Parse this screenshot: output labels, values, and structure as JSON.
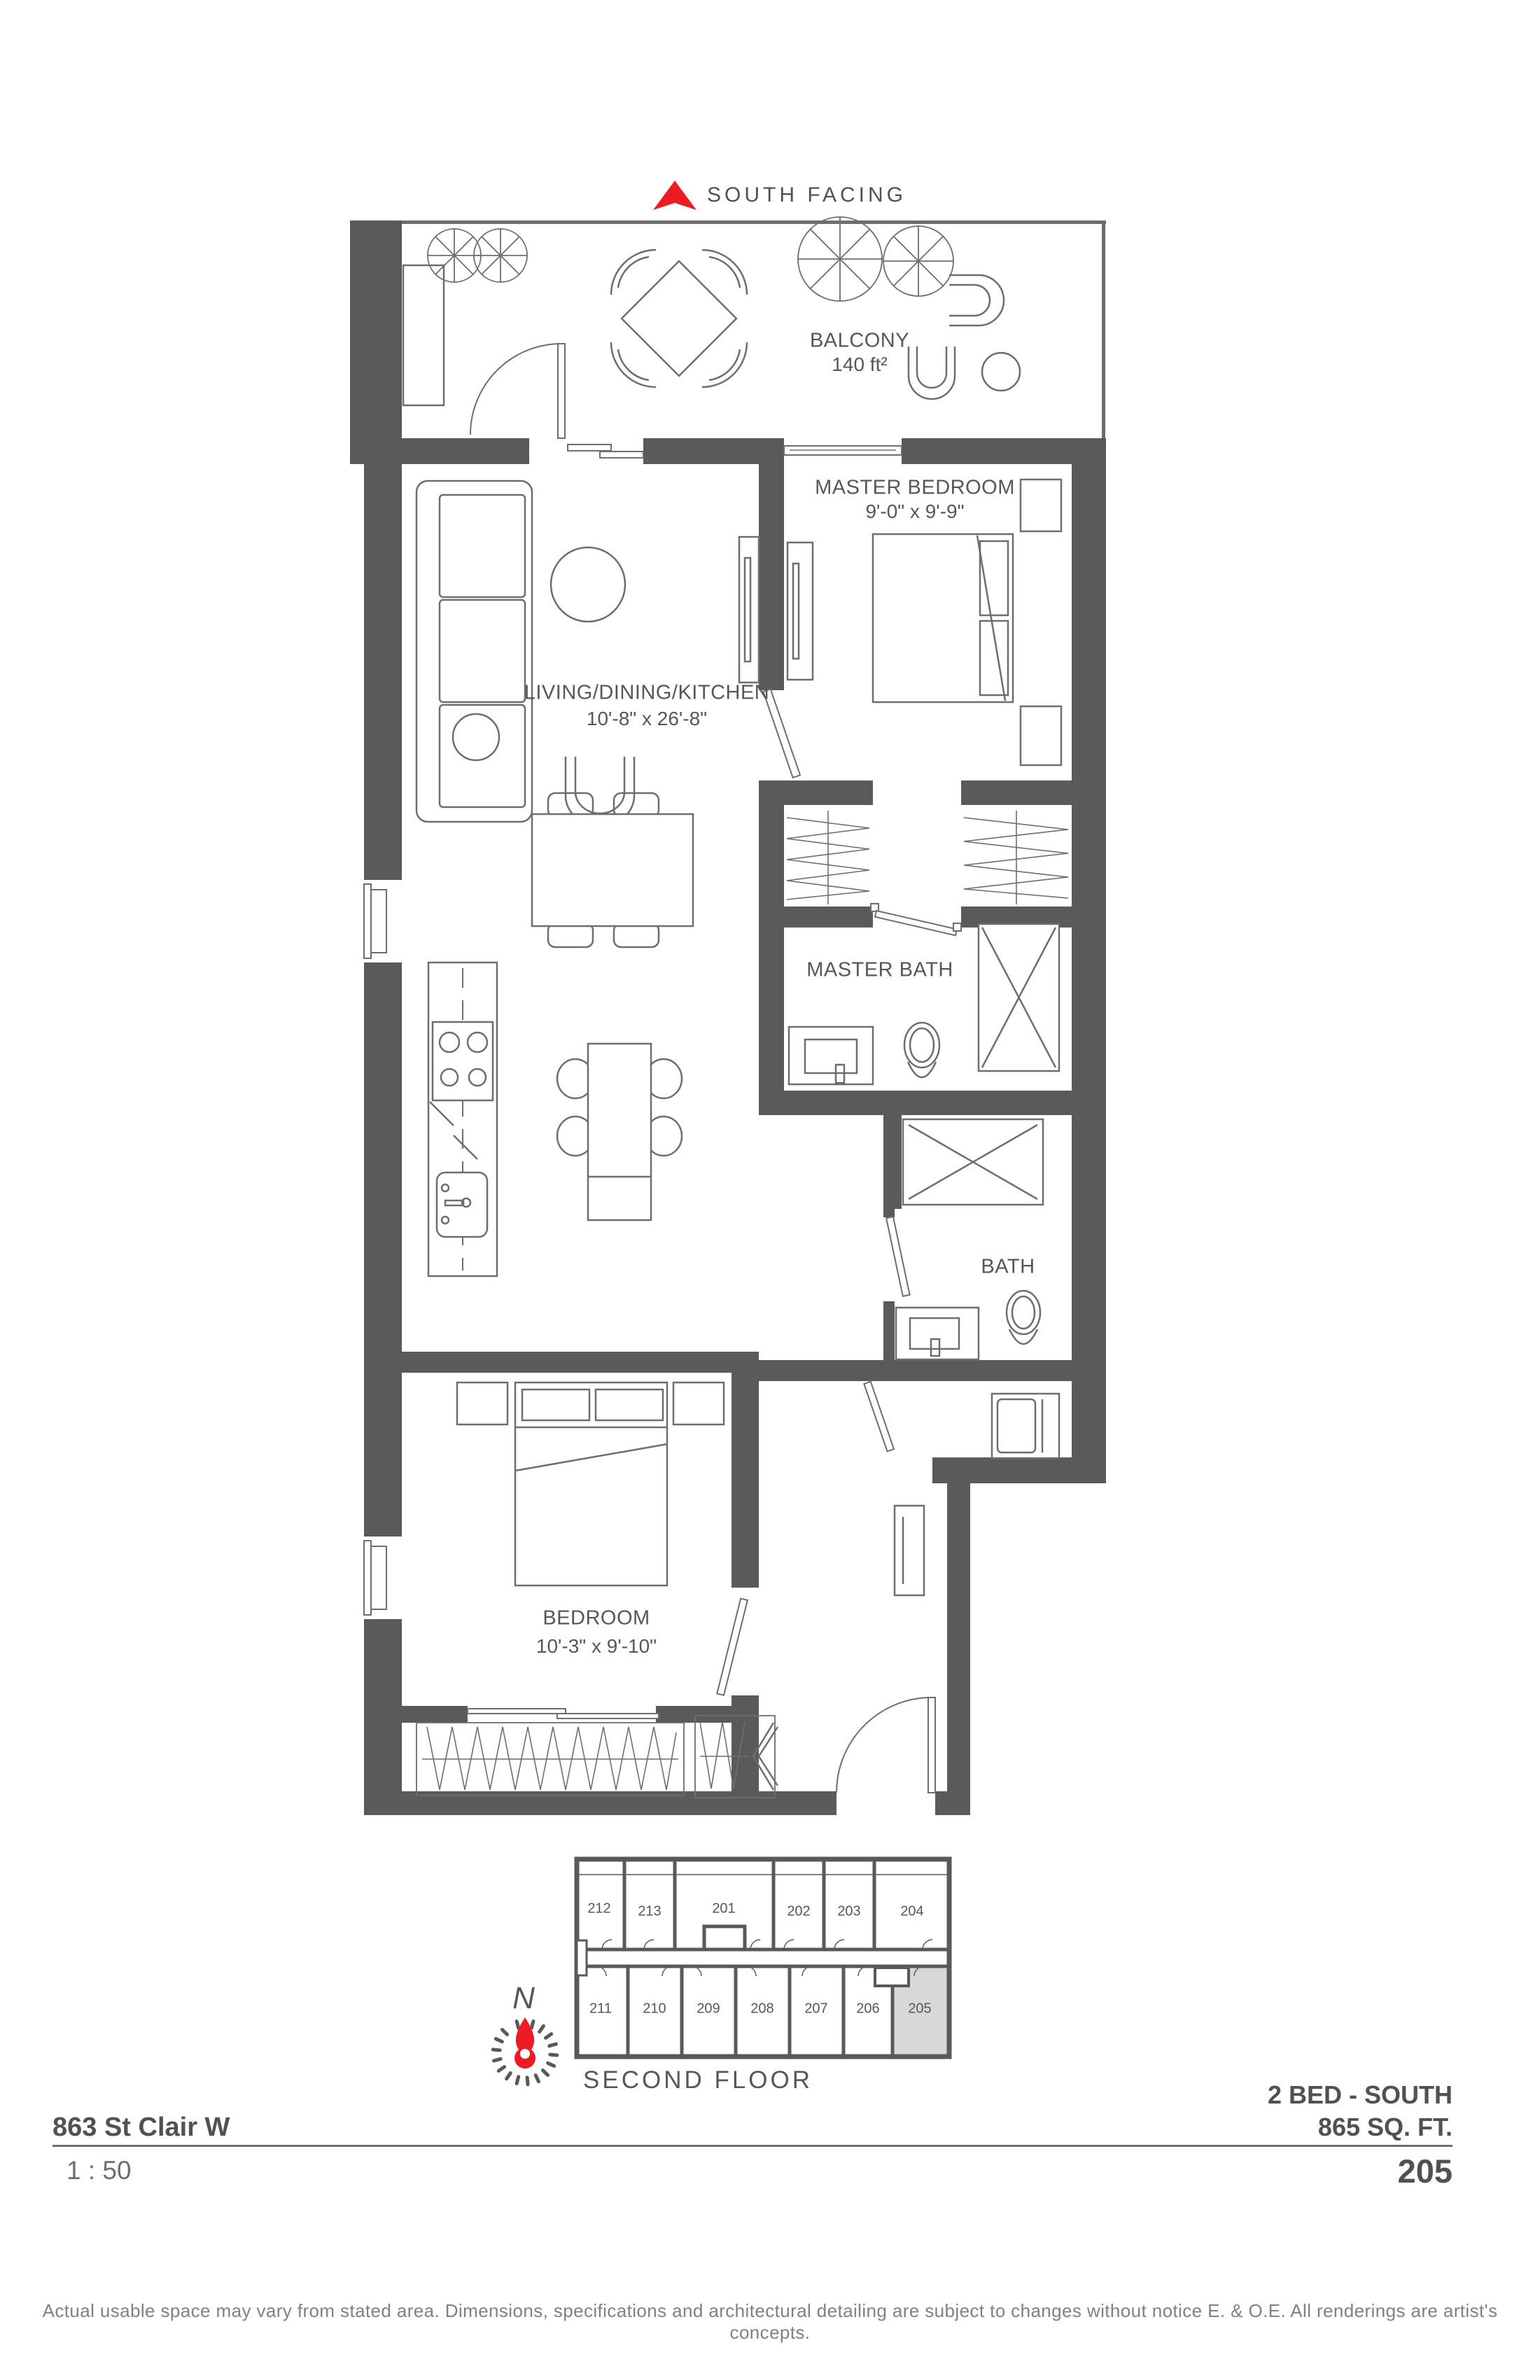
{
  "header": {
    "south_facing": "SOUTH FACING"
  },
  "plan": {
    "balcony": {
      "name": "BALCONY",
      "area": "140 ft²"
    },
    "master_bedroom": {
      "name": "MASTER BEDROOM",
      "dims": "9'-0\" x 9'-9\""
    },
    "living": {
      "name": "LIVING/DINING/KITCHEN",
      "dims": "10'-8\" x 26'-8\""
    },
    "master_bath": {
      "name": "MASTER BATH"
    },
    "bath": {
      "name": "BATH"
    },
    "bedroom": {
      "name": "BEDROOM",
      "dims": "10'-3\" x 9'-10\""
    }
  },
  "keyplan": {
    "compass_label": "N",
    "floor_label": "SECOND FLOOR",
    "highlighted_unit": "205",
    "top_row": [
      "212",
      "213",
      "201",
      "202",
      "203",
      "204"
    ],
    "bottom_row": [
      "211",
      "210",
      "209",
      "208",
      "207",
      "206",
      "205"
    ]
  },
  "titleblock": {
    "address": "863 St Clair W",
    "scale": "1 : 50",
    "unit_type": "2 BED  - SOUTH",
    "area": "865 SQ. FT.",
    "unit_number": "205"
  },
  "footer": {
    "disclaimer": "Actual usable space may vary from stated area. Dimensions, specifications and architectural detailing are subject to changes without notice E. & O.E. All renderings are artist's concepts."
  },
  "colors": {
    "wall": "#595a5c",
    "line": "#6d6e71",
    "accent_red": "#ec1c24",
    "unit_highlight": "#d8d8d8",
    "text": "#58595b"
  }
}
